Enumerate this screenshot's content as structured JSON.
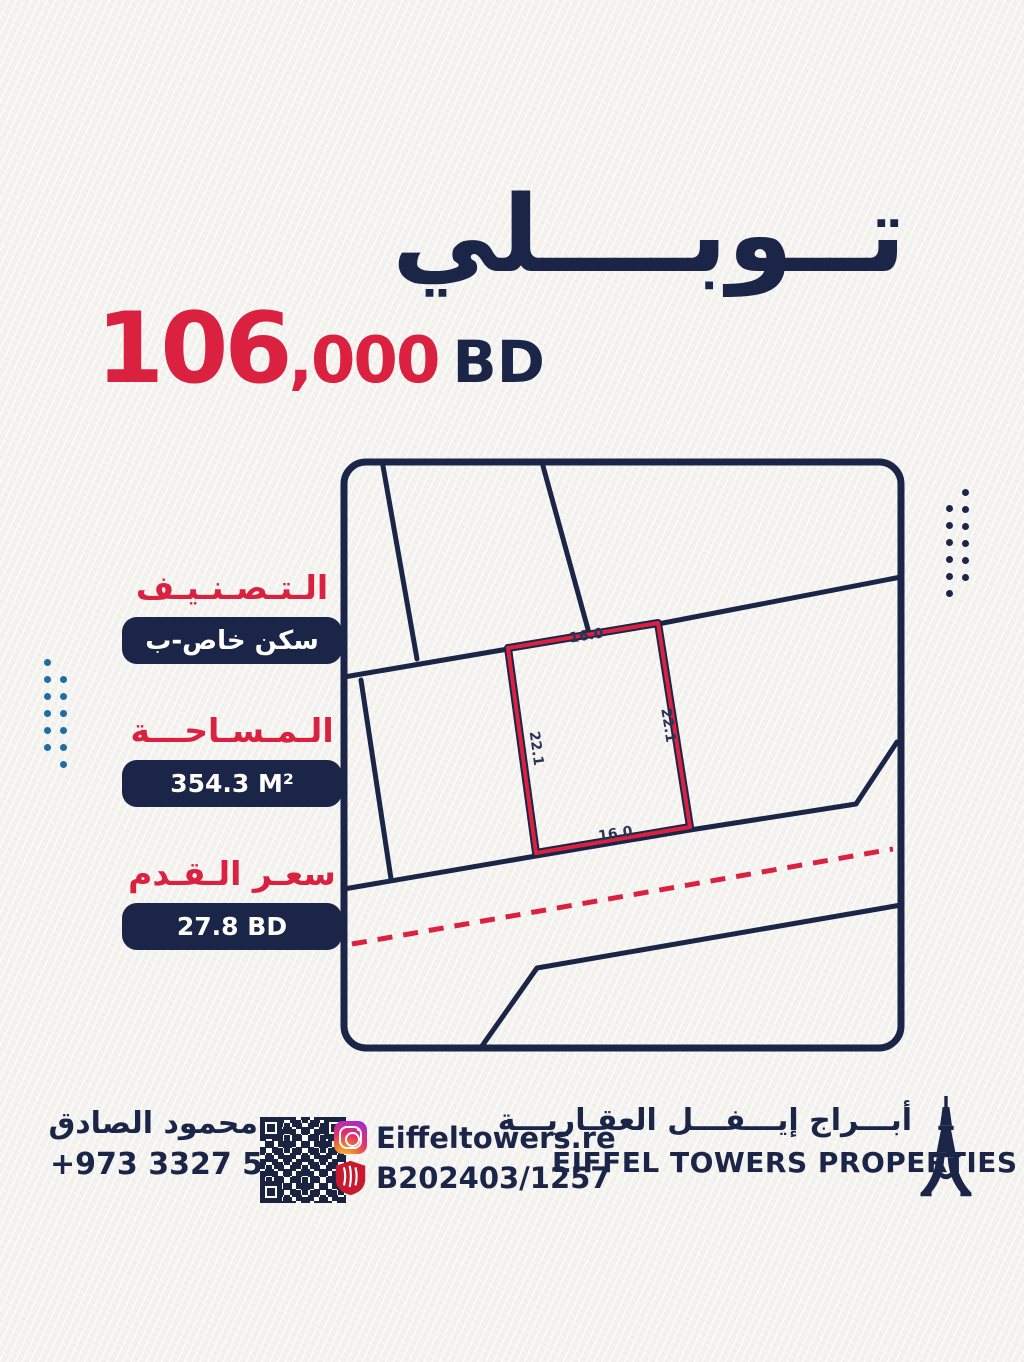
{
  "poster": {
    "title": "تــوبــــلي",
    "price": {
      "main": "106",
      "thousands": ",000",
      "currency": "BD"
    },
    "specs": [
      {
        "label": "الـتـصـنـيـف",
        "value": "سكن خاص-ب"
      },
      {
        "label": "الـمـسـاحـــة",
        "value": "354.3 M²"
      },
      {
        "label": "سعـر الـقـدم",
        "value": "27.8 BD"
      }
    ],
    "map": {
      "top_dim": "16.0",
      "right_dim": "22.1",
      "left_dim": "22.1",
      "bottom_dim": "16.0"
    },
    "footer": {
      "agent_name": "محمود الصادق",
      "agent_phone": "+973 3327 5261",
      "instagram_handle": "Eiffeltowers.re",
      "license_number": "B202403/1257",
      "brand_ar": "أبـــراج إيـــفـــل العقـاريـــة",
      "brand_en": "EIFFEL TOWERS PROPERTIES"
    },
    "colors": {
      "navy": "#1b2547",
      "red": "#da2140",
      "blue_dots": "#1d6ea6",
      "paper": "#f4f3ef"
    }
  }
}
